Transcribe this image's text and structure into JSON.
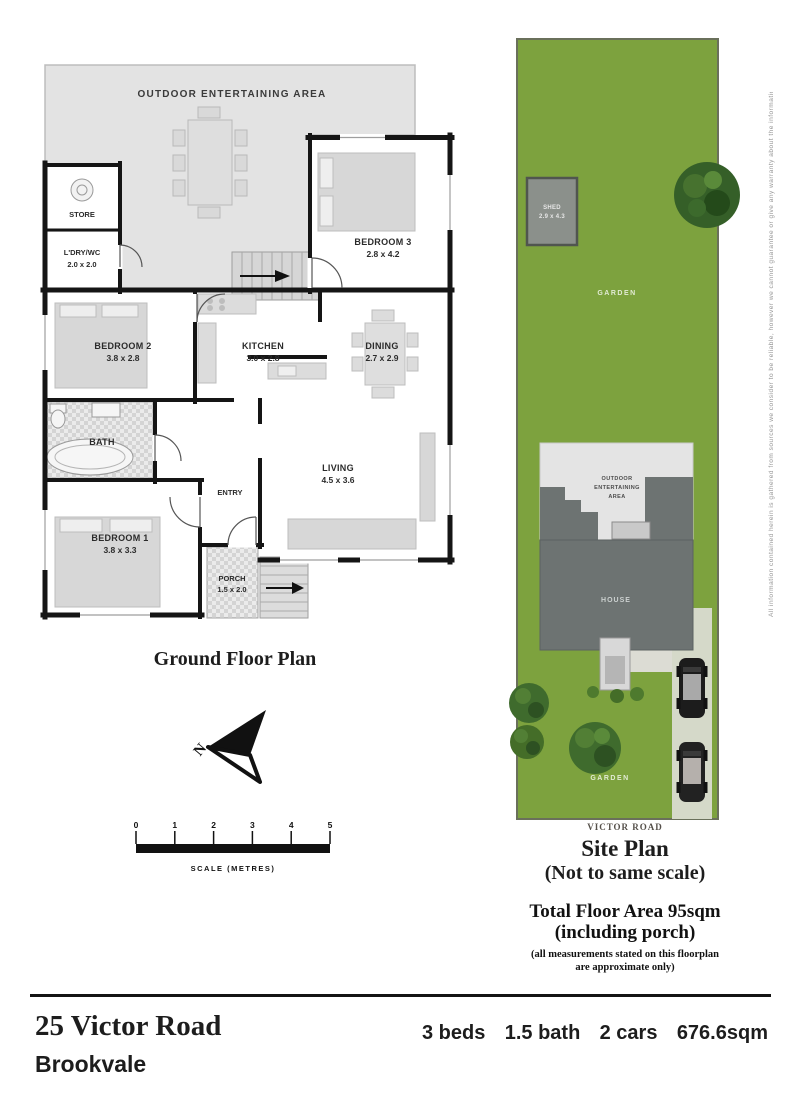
{
  "floor_plan": {
    "title": "Ground Floor Plan",
    "rooms": [
      {
        "name": "OUTDOOR ENTERTAINING AREA",
        "dims": ""
      },
      {
        "name": "STORE",
        "dims": ""
      },
      {
        "name": "L'DRY/WC",
        "dims": "2.0 x 2.0"
      },
      {
        "name": "BEDROOM 3",
        "dims": "2.8 x 4.2"
      },
      {
        "name": "BEDROOM 2",
        "dims": "3.8 x 2.8"
      },
      {
        "name": "KITCHEN",
        "dims": "3.0 x 2.8"
      },
      {
        "name": "DINING",
        "dims": "2.7 x 2.9"
      },
      {
        "name": "BATH",
        "dims": ""
      },
      {
        "name": "ENTRY",
        "dims": ""
      },
      {
        "name": "LIVING",
        "dims": "4.5 x 3.6"
      },
      {
        "name": "BEDROOM 1",
        "dims": "3.8 x 3.3"
      },
      {
        "name": "PORCH",
        "dims": "1.5 x 2.0"
      }
    ],
    "compass_label": "N",
    "scale": {
      "ticks": [
        "0",
        "1",
        "2",
        "3",
        "4",
        "5"
      ],
      "caption": "SCALE (METRES)"
    }
  },
  "site_plan": {
    "title": "Site Plan",
    "subtitle": "(Not to same scale)",
    "road_label": "VICTOR ROAD",
    "garden_label_top": "GARDEN",
    "garden_label_bottom": "GARDEN",
    "shed_label": "SHED",
    "shed_dims": "2.9 x 4.3",
    "house_label": "HOUSE",
    "outdoor_line1": "OUTDOOR",
    "outdoor_line2": "ENTERTAINING",
    "outdoor_line3": "AREA"
  },
  "summary": {
    "total_area_line1": "Total Floor Area 95sqm",
    "total_area_line2": "(including porch)",
    "disclaimer_line1": "(all measurements stated on this floorplan",
    "disclaimer_line2": "are approximate only)"
  },
  "side_note": "All information contained herein is gathered from sources we consider to be reliable, however we cannot guarantee or give any warranty about the information provided and interested parties must rely on their own enquiries",
  "footer": {
    "address_line1": "25 Victor Road",
    "address_line2": "Brookvale",
    "stats": [
      "3 beds",
      "1.5 bath",
      "2 cars",
      "676.6sqm"
    ]
  },
  "colors": {
    "garden_green": "#7da23e",
    "house_gray": "#6d7372",
    "outdoor_gray": "#e3e3e3",
    "wall_black": "#151515",
    "driveway": "#d5d9c9"
  }
}
